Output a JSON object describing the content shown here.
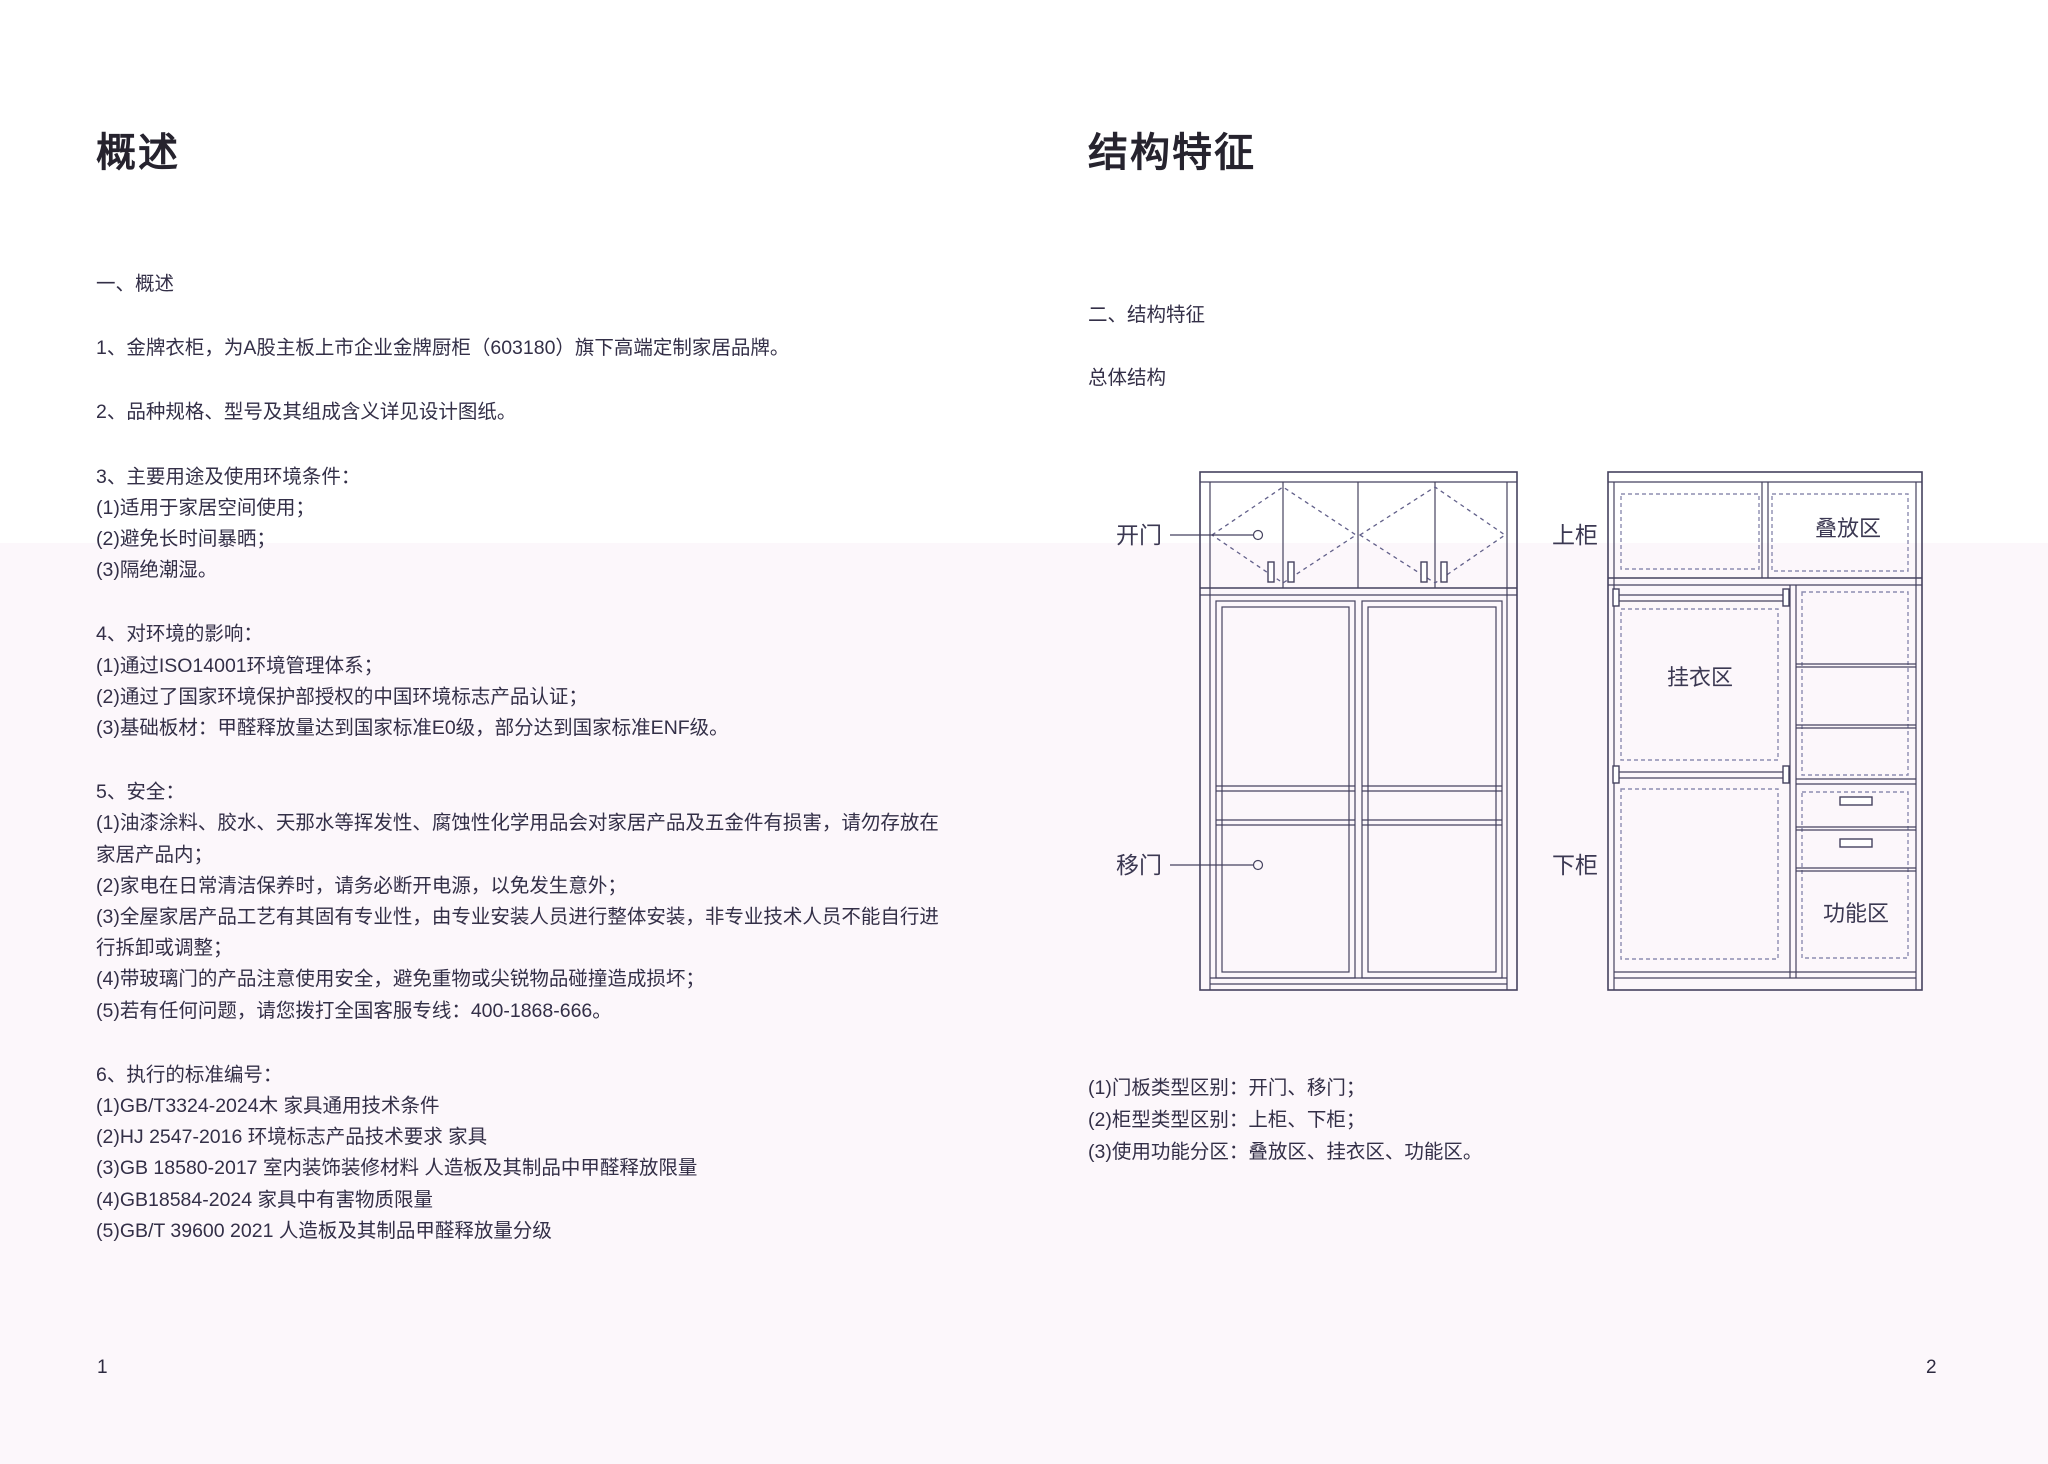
{
  "colors": {
    "background_top": "#ffffff",
    "background_band": "#fcf7fb",
    "body_text": "#332f47",
    "title_text": "#26232e",
    "diagram_line": "#45425f",
    "diagram_dashed": "#8d8db1"
  },
  "left_page": {
    "title": "概述",
    "page_number": "1",
    "blocks": [
      {
        "lines": [
          "一、概述"
        ]
      },
      {
        "lines": [
          "1、金牌衣柜，为A股主板上市企业金牌厨柜（603180）旗下高端定制家居品牌。"
        ]
      },
      {
        "lines": [
          "2、品种规格、型号及其组成含义详见设计图纸。"
        ]
      },
      {
        "lines": [
          "3、主要用途及使用环境条件：",
          "(1)适用于家居空间使用；",
          "(2)避免长时间暴晒；",
          "(3)隔绝潮湿。"
        ]
      },
      {
        "lines": [
          "4、对环境的影响：",
          "(1)通过ISO14001环境管理体系；",
          "(2)通过了国家环境保护部授权的中国环境标志产品认证；",
          "(3)基础板材：甲醛释放量达到国家标准E0级，部分达到国家标准ENF级。"
        ]
      },
      {
        "lines": [
          "5、安全：",
          "(1)油漆涂料、胶水、天那水等挥发性、腐蚀性化学用品会对家居产品及五金件有损害，请勿存放在",
          "家居产品内；",
          "(2)家电在日常清洁保养时，请务必断开电源，以免发生意外；",
          "(3)全屋家居产品工艺有其固有专业性，由专业安装人员进行整体安装，非专业技术人员不能自行进",
          "行拆卸或调整；",
          "(4)带玻璃门的产品注意使用安全，避免重物或尖锐物品碰撞造成损坏；",
          "(5)若有任何问题，请您拨打全国客服专线：400-1868-666。"
        ]
      },
      {
        "lines": [
          "6、执行的标准编号：",
          "(1)GB/T3324-2024木 家具通用技术条件",
          "(2)HJ 2547-2016 环境标志产品技术要求 家具",
          "(3)GB 18580-2017 室内装饰装修材料 人造板及其制品中甲醛释放限量",
          "(4)GB18584-2024 家具中有害物质限量",
          "(5)GB/T 39600 2021 人造板及其制品甲醛释放量分级"
        ]
      }
    ]
  },
  "right_page": {
    "title": "结构特征",
    "section_heading": "二、结构特征",
    "subsection_heading": "总体结构",
    "page_number": "2",
    "notes": [
      "(1)门板类型区别：开门、移门；",
      "(2)柜型类型区别：上柜、下柜；",
      "(3)使用功能分区：叠放区、挂衣区、功能区。"
    ],
    "diagram_labels": {
      "door_hinged": "开门",
      "door_sliding": "移门",
      "cabinet_upper": "上柜",
      "cabinet_lower": "下柜",
      "zone_stacking": "叠放区",
      "zone_hanging": "挂衣区",
      "zone_function": "功能区"
    }
  }
}
